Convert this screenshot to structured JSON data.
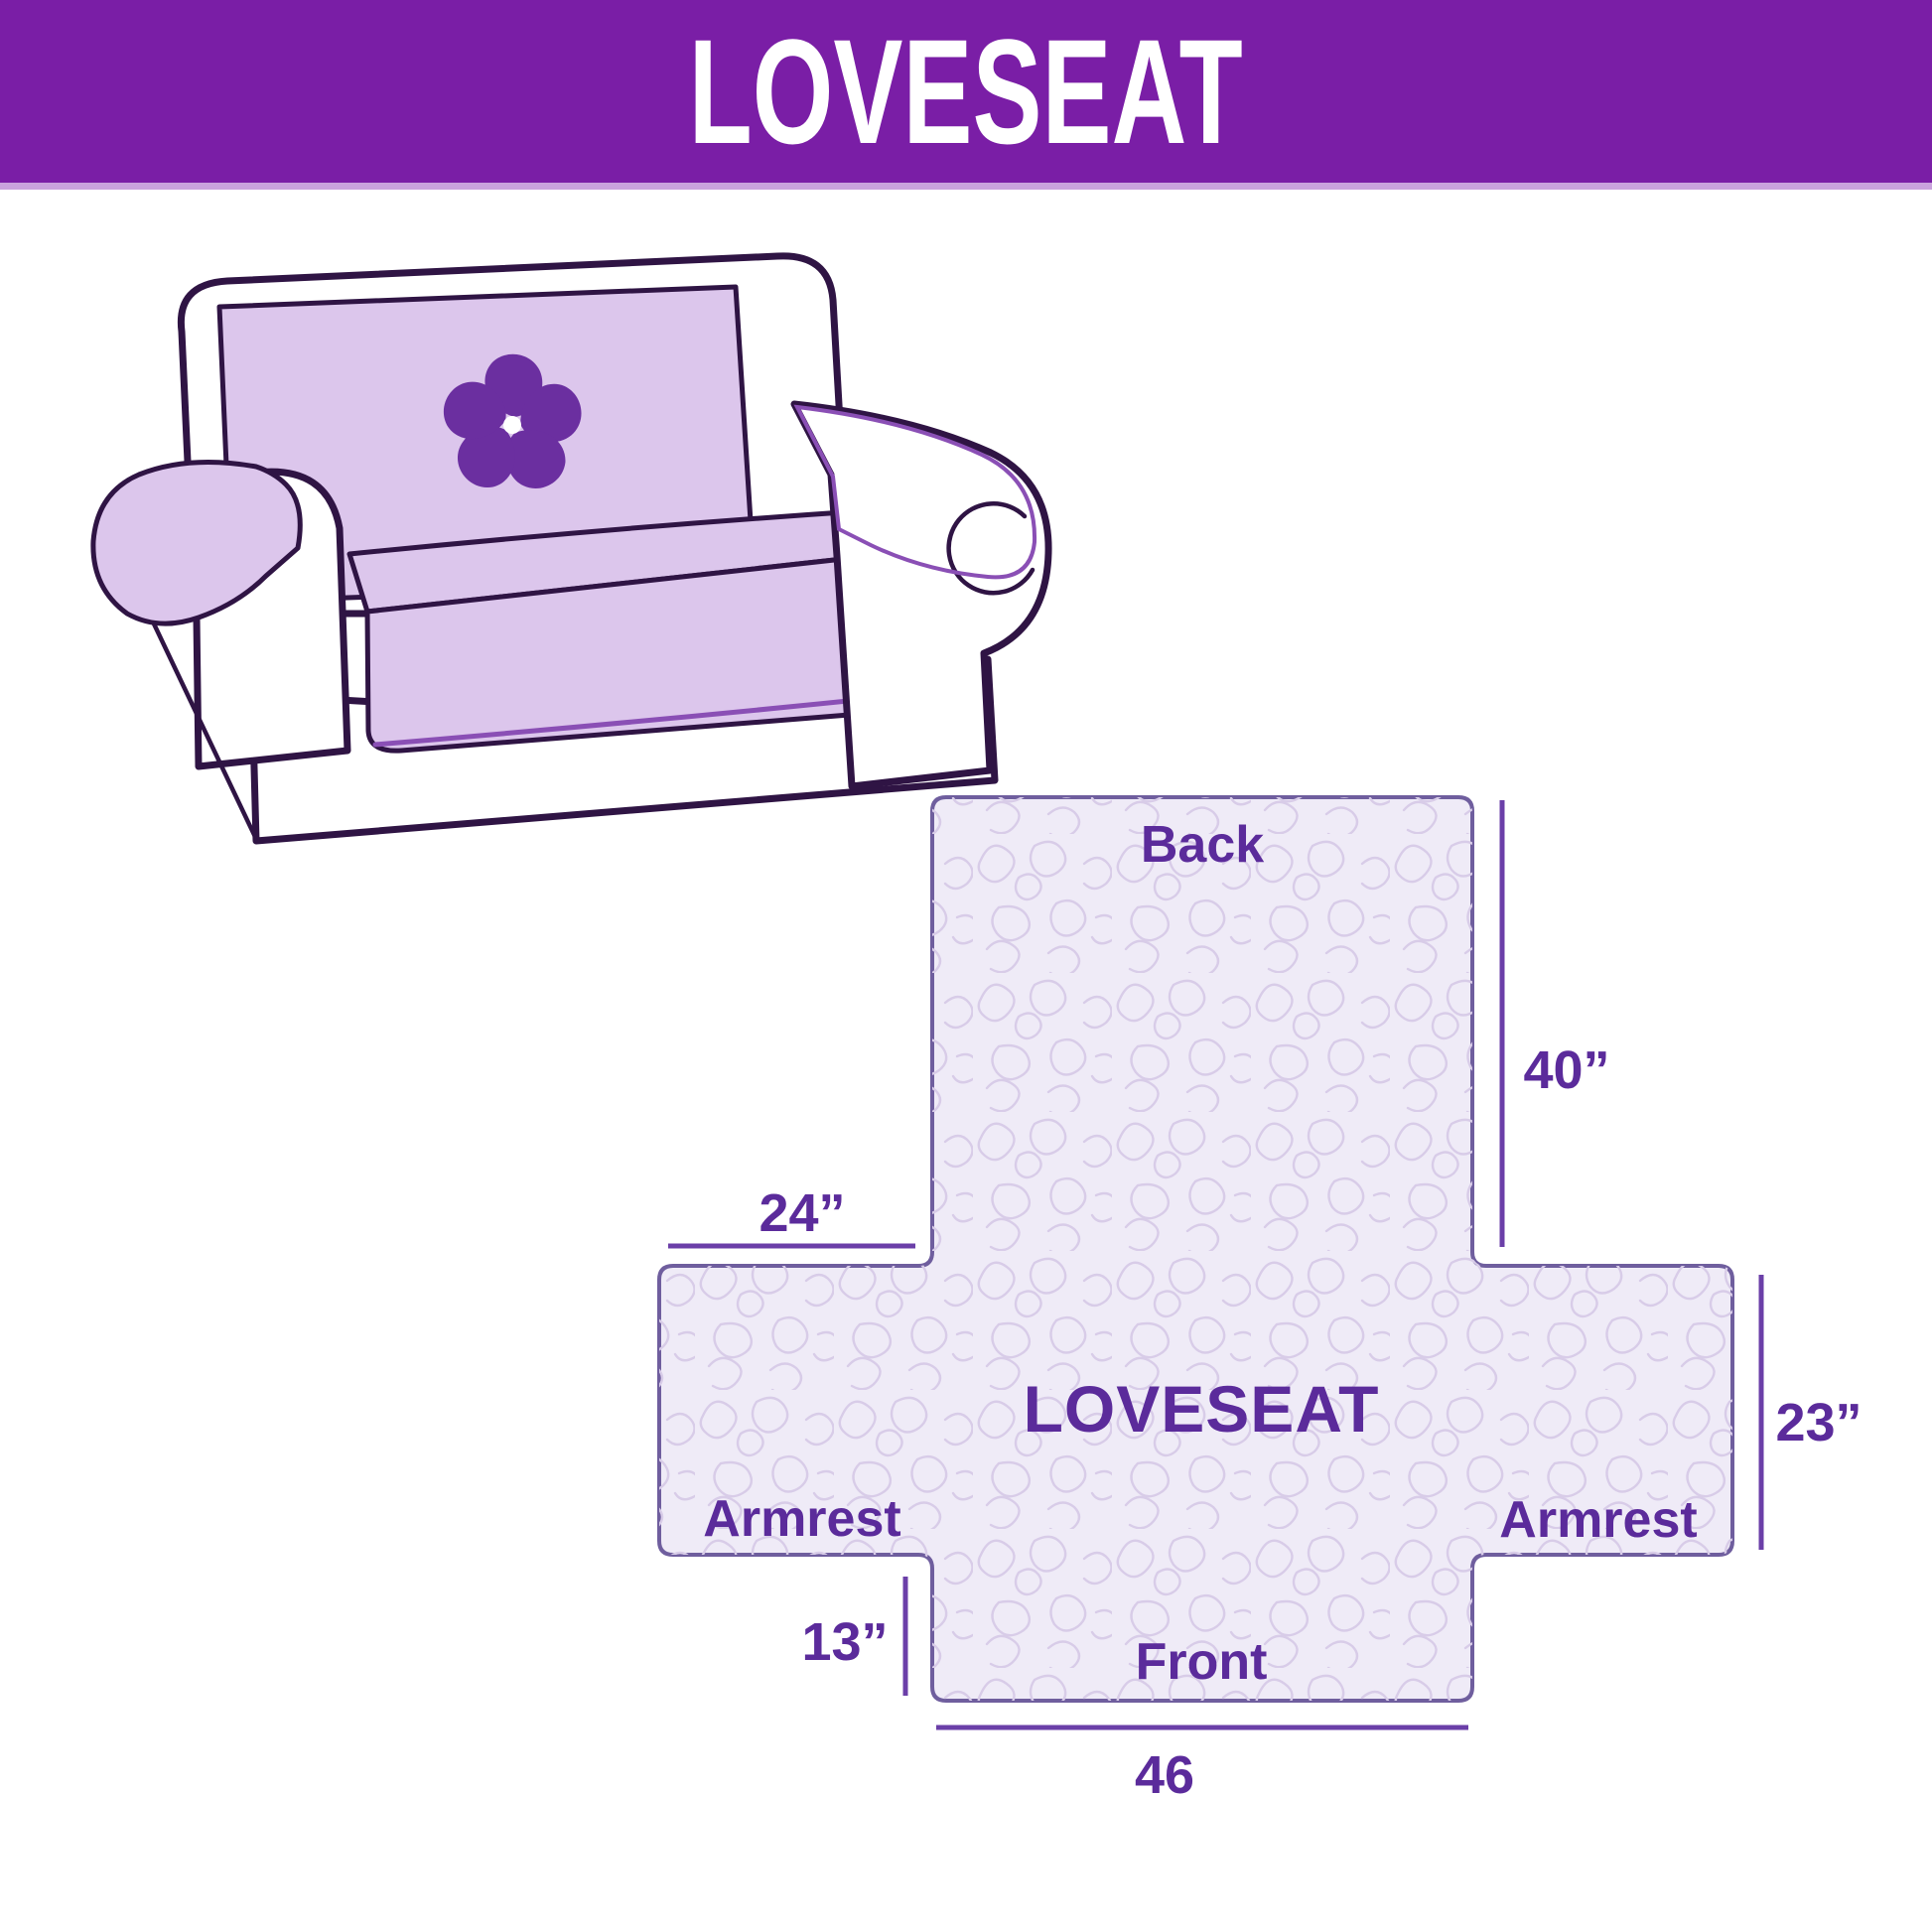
{
  "banner": {
    "title": "LOVESEAT"
  },
  "sofa": {
    "logo_icon": "pinwheel-flower",
    "colors": {
      "outline": "#2F1444",
      "cover": "#DCC6EC",
      "trim": "#8A4FB5",
      "logo": "#6B2FA0",
      "body": "#FFFFFF"
    }
  },
  "diagram": {
    "center_label": "LOVESEAT",
    "back_label": "Back",
    "front_label": "Front",
    "armrest_left_label": "Armrest",
    "armrest_right_label": "Armrest",
    "dimensions": {
      "back_height": "40”",
      "armrest_top_width": "24”",
      "armrest_side_height": "23”",
      "front_skirt_drop": "13”",
      "front_width": "46"
    },
    "colors": {
      "fill": "#EFEBF7",
      "pattern": "#D8CCE8",
      "outline": "#6F5E9E",
      "dimension_lines": "#6B3FA8",
      "labels": "#5B2B9B"
    }
  }
}
